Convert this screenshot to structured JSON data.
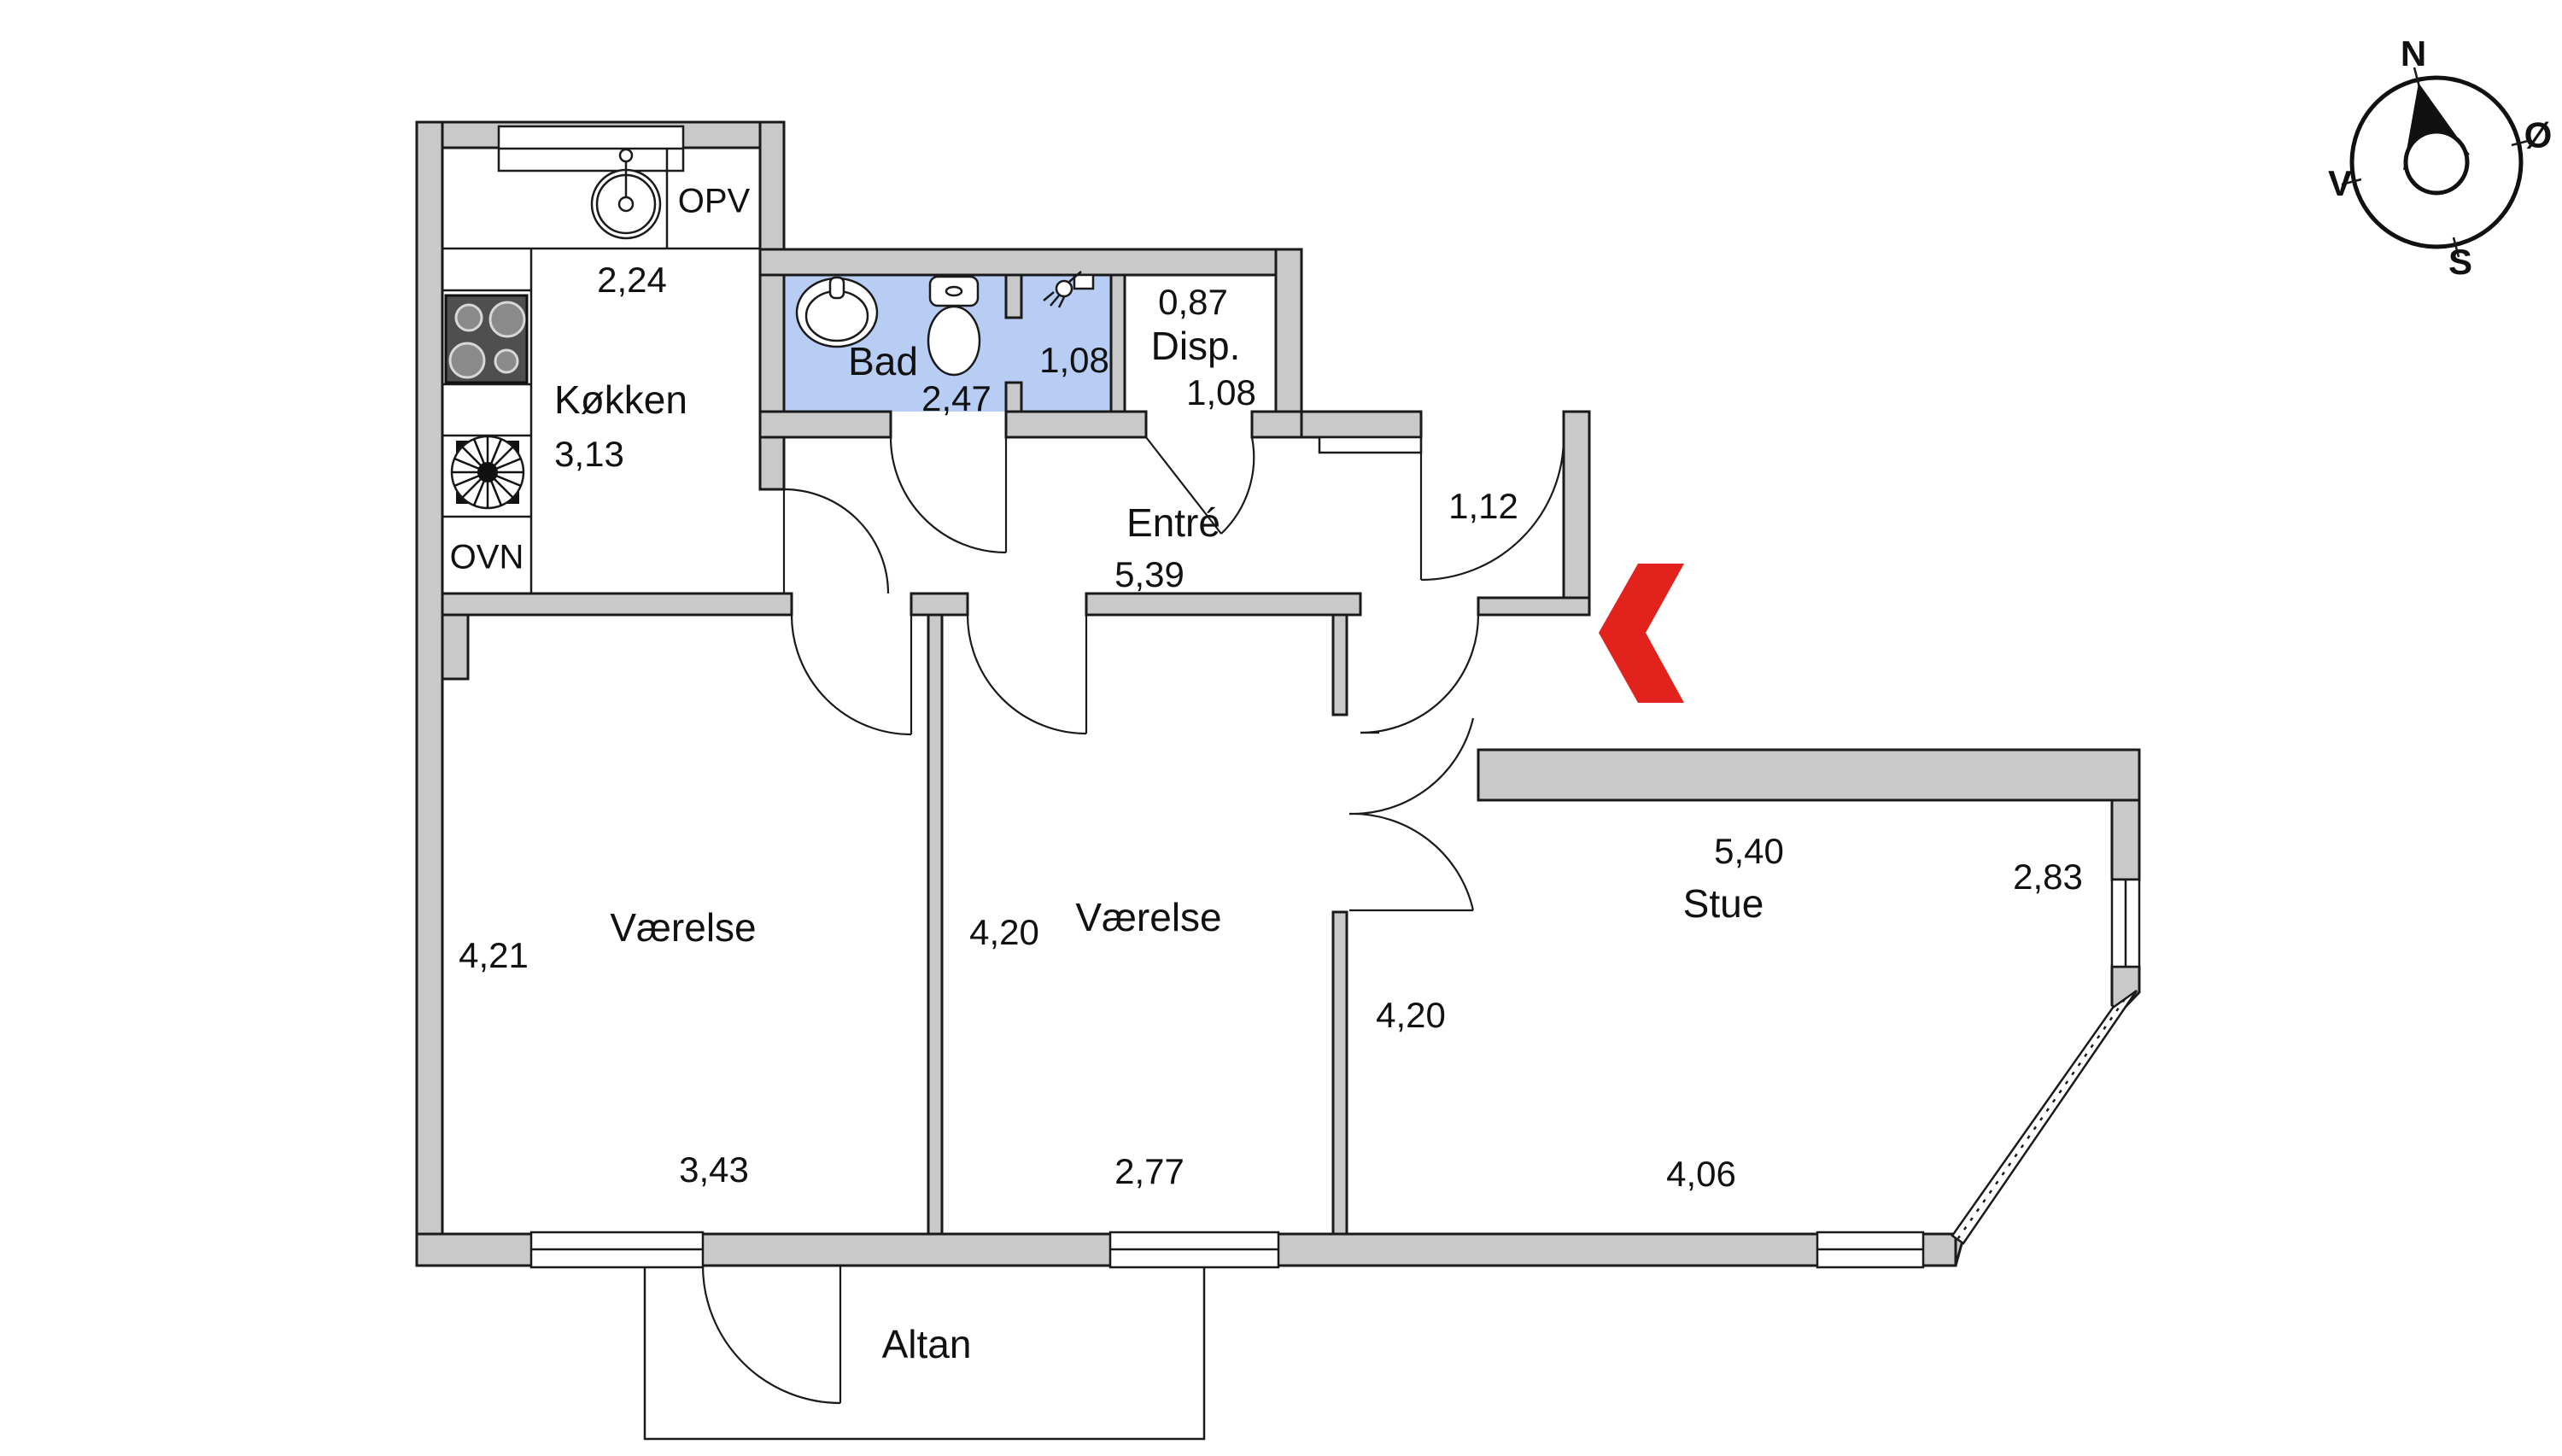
{
  "plan": {
    "colors": {
      "wall_fill": "#c9c9c9",
      "bath_floor": "#b7cdf4",
      "entrance_arrow": "#e2231d",
      "line": "#1a1a1a"
    },
    "rooms": {
      "kitchen": {
        "label": "Køkken",
        "width": "2,24",
        "depth": "3,13"
      },
      "bath": {
        "label": "Bad",
        "width": "2,47",
        "nook_width": "1,08"
      },
      "storage": {
        "label": "Disp.",
        "width": "0,87",
        "depth": "1,08"
      },
      "hall": {
        "label": "Entré",
        "length": "5,39",
        "entrance_width": "1,12"
      },
      "bedroom_left": {
        "label": "Værelse",
        "depth": "4,21",
        "width": "3,43"
      },
      "bedroom_mid": {
        "label": "Værelse",
        "depth": "4,20",
        "width": "2,77"
      },
      "living": {
        "label": "Stue",
        "top": "5,40",
        "right": "2,83",
        "left": "4,20",
        "bottom": "4,06"
      },
      "balcony": {
        "label": "Altan"
      }
    },
    "appliances": {
      "dishwasher": "OPV",
      "oven": "OVN"
    },
    "compass": {
      "north": "N",
      "east": "Ø",
      "south": "S",
      "west": "V"
    }
  }
}
